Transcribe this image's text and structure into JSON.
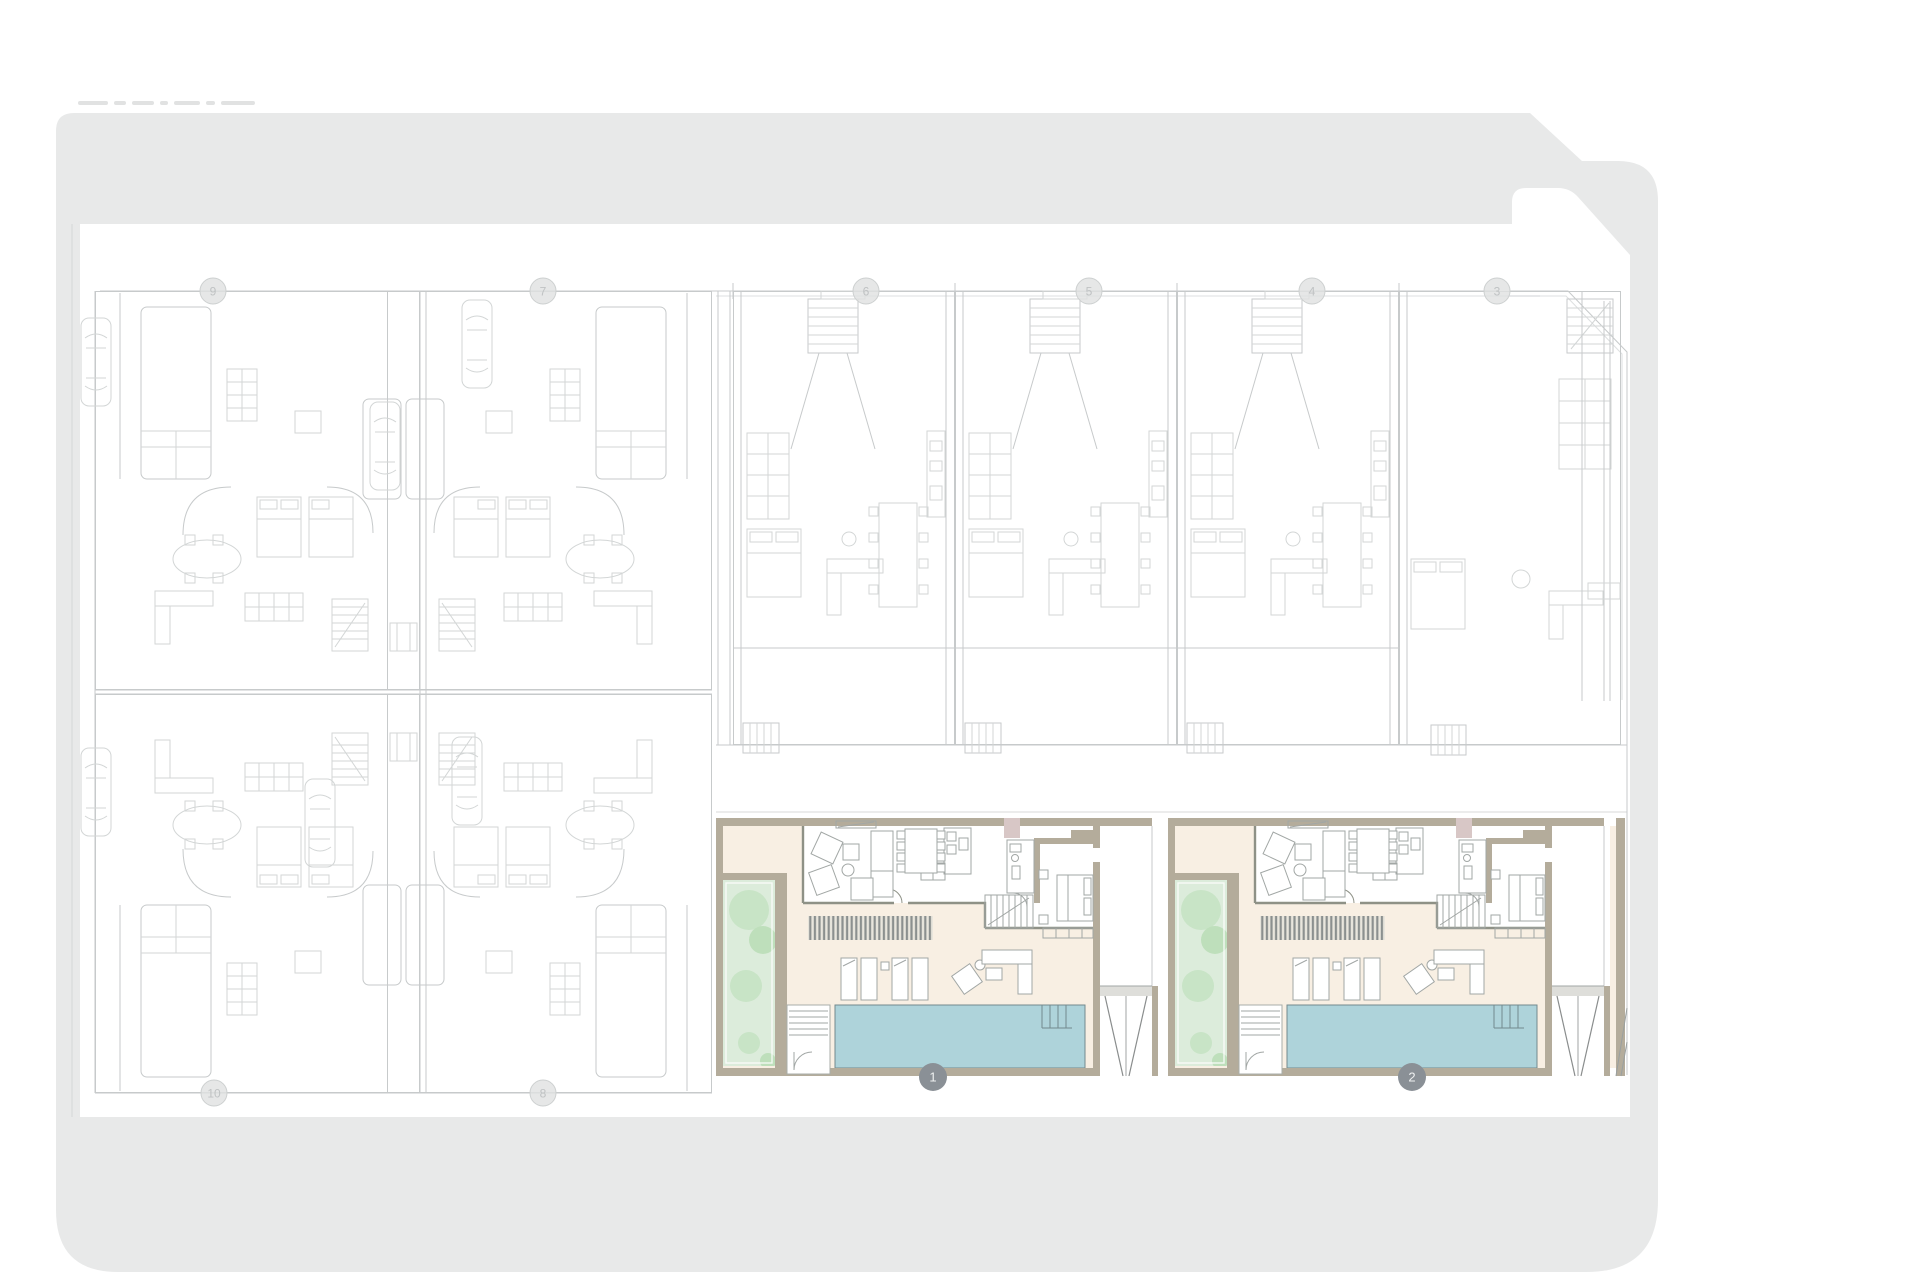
{
  "site_plan": {
    "colors": {
      "street_gray": "#e8e9e9",
      "plot_beige": "#f8efe3",
      "wall_tan": "#b4ac9b",
      "interior_wall": "#8e9186",
      "gray_line": "#c7cacb",
      "furn_line": "#a2a7a5",
      "garden_green": "#dcecdb",
      "tree_green": "#c8e4c6",
      "tree_green_dark": "#bedfbb",
      "pool_blue": "#aed3da",
      "pool_edge": "#73898e",
      "louver_gray": "#8b908f",
      "mauve": "#d8c7c6",
      "marker_active": "#8a9096",
      "marker_muted": "#e0e1e1"
    },
    "markers": {
      "top_row": [
        {
          "label": "9"
        },
        {
          "label": "7"
        },
        {
          "label": "6"
        },
        {
          "label": "5"
        },
        {
          "label": "4"
        },
        {
          "label": "3"
        }
      ],
      "bottom_row": [
        {
          "label": "10"
        },
        {
          "label": "8"
        }
      ],
      "highlighted": [
        {
          "label": "1"
        },
        {
          "label": "2"
        }
      ]
    }
  }
}
